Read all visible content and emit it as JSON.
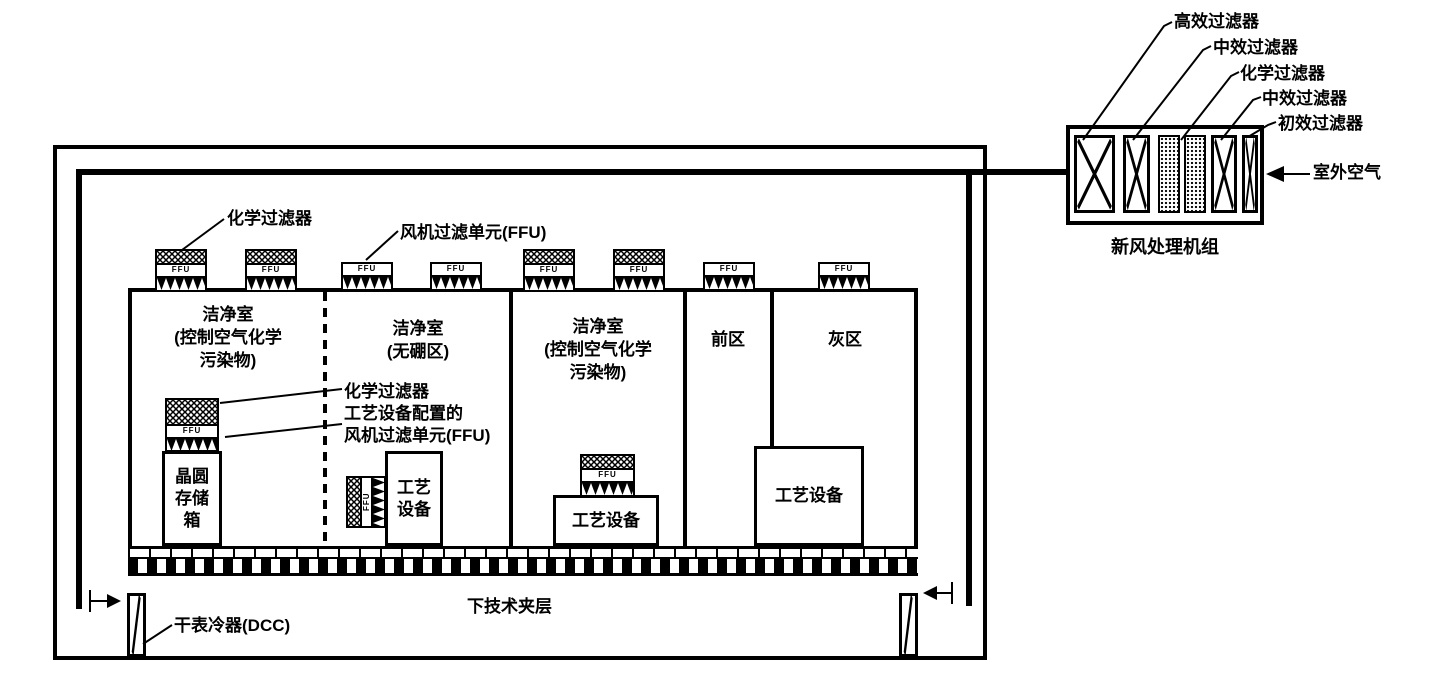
{
  "ahu": {
    "label": "新风处理机组",
    "outdoor_air_label": "室外空气",
    "filter_callouts": [
      "高效过滤器",
      "中效过滤器",
      "化学过滤器",
      "中效过滤器",
      "初效过滤器"
    ]
  },
  "roof": {
    "chemical_filter_callout": "化学过滤器",
    "ffu_callout": "风机过滤单元(FFU)",
    "ffu_text": "FFU"
  },
  "rooms": {
    "cleanroom1": {
      "line1": "洁净室",
      "line2": "(控制空气化学",
      "line3": "污染物)"
    },
    "cleanroom2": {
      "line1": "洁净室",
      "line2": "(无硼区)"
    },
    "cleanroom3": {
      "line1": "洁净室",
      "line2": "(控制空气化学",
      "line3": "污染物)"
    },
    "front_zone": "前区",
    "gray_zone": "灰区"
  },
  "tool_ffu_callout": {
    "line1": "化学过滤器",
    "line2": "工艺设备配置的",
    "line3": "风机过滤单元(FFU)"
  },
  "equipment": {
    "wafer_box": {
      "line1": "晶圆",
      "line2": "存储",
      "line3": "箱"
    },
    "process_tool_stacked": {
      "line1": "工艺",
      "line2": "设备"
    },
    "process_tool_inline": "工艺设备"
  },
  "plenum": {
    "label": "下技术夹层",
    "dcc_label": "干表冷器(DCC)"
  }
}
